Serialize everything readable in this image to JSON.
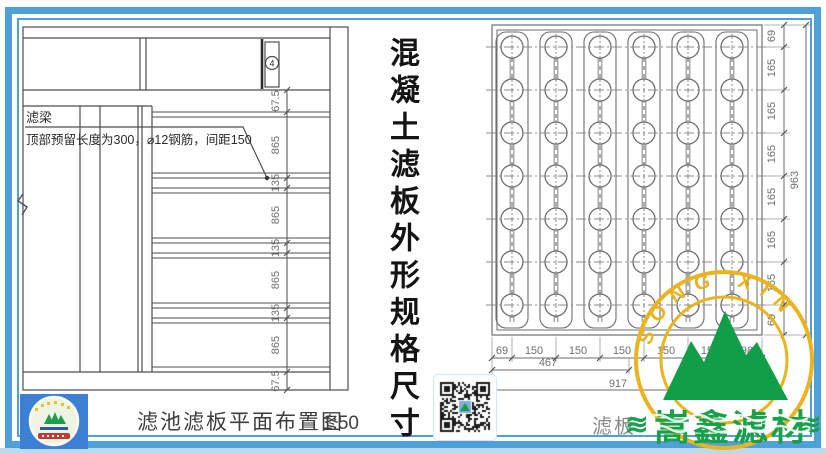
{
  "title": {
    "vertical_text": "混凝土滤板外形规格尺寸"
  },
  "left_drawing": {
    "caption": "滤池滤板平面布置图",
    "scale": "1:50",
    "detail_marker": "4",
    "leader": {
      "title": "滤梁",
      "note": "顶部预留长度为300，⌀12钢筋，间距150"
    },
    "dim_chain": [
      "67.5",
      "865",
      "135",
      "865",
      "135",
      "865",
      "135",
      "865",
      "67.5"
    ]
  },
  "right_drawing": {
    "caption": "滤板",
    "right_chain": [
      "69",
      "165",
      "165",
      "165",
      "165",
      "165",
      "165",
      "69"
    ],
    "right_total": "963",
    "bottom_chain": [
      "69",
      "150",
      "150",
      "150",
      "150",
      "150",
      "98"
    ],
    "bottom_sub_total": "467",
    "bottom_total": "917"
  },
  "branding": {
    "stamp_arc_text": "SONG  XIN",
    "watermark_text": "嵩鑫滤材",
    "watermark_flourish": "≋",
    "colors": {
      "frame_blue": "#4f9fd9",
      "stamp_yellow": "#eab41e",
      "brand_green": "#149c49"
    }
  }
}
